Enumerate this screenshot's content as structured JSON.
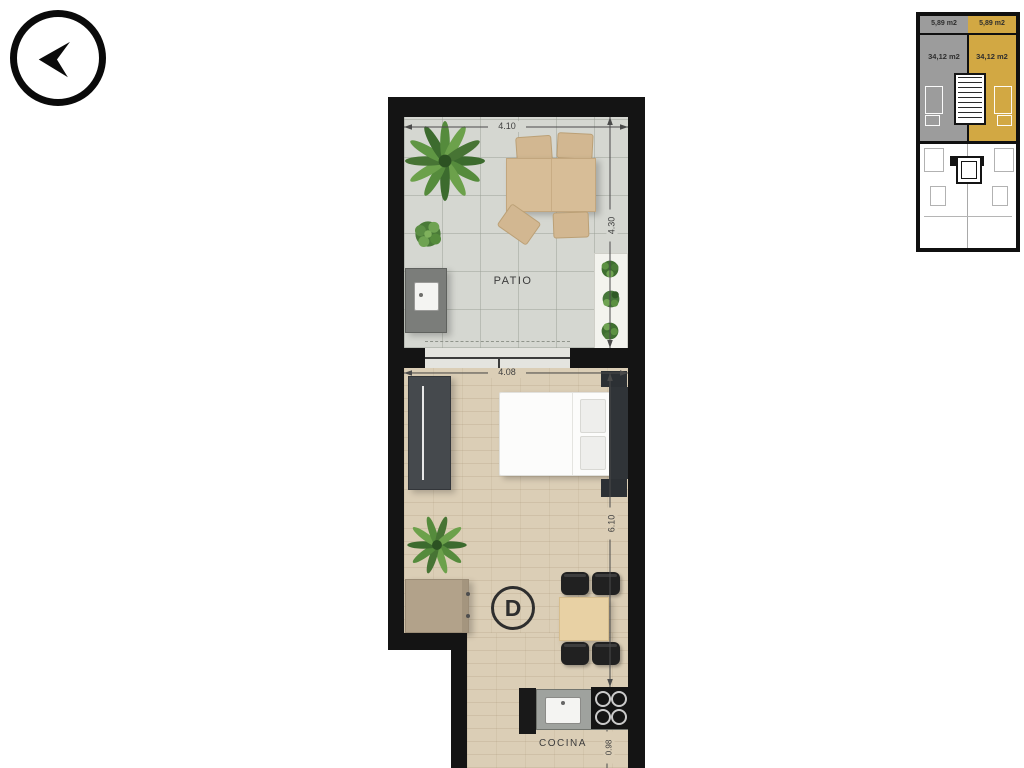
{
  "floor_plan": {
    "unit_label": "D",
    "room_labels": {
      "patio": "PATIO",
      "kitchen": "COCINA"
    },
    "dimensions": {
      "patio_width": "4.10",
      "patio_depth": "4.30",
      "room_width": "4.08",
      "room_depth": "6.10",
      "kitchen_width": "0.98"
    }
  },
  "key_plan": {
    "units": [
      {
        "balcony_area": "5,89 m2",
        "unit_area": "34,12 m2",
        "highlighted": false
      },
      {
        "balcony_area": "5,89 m2",
        "unit_area": "34,12 m2",
        "highlighted": true
      }
    ],
    "highlight_color": "#d2a843",
    "muted_color": "#9c9c9c"
  },
  "colors": {
    "wall": "#141414",
    "patio_floor": "#d5d7d1",
    "wood_floor": "#dbceb6"
  }
}
